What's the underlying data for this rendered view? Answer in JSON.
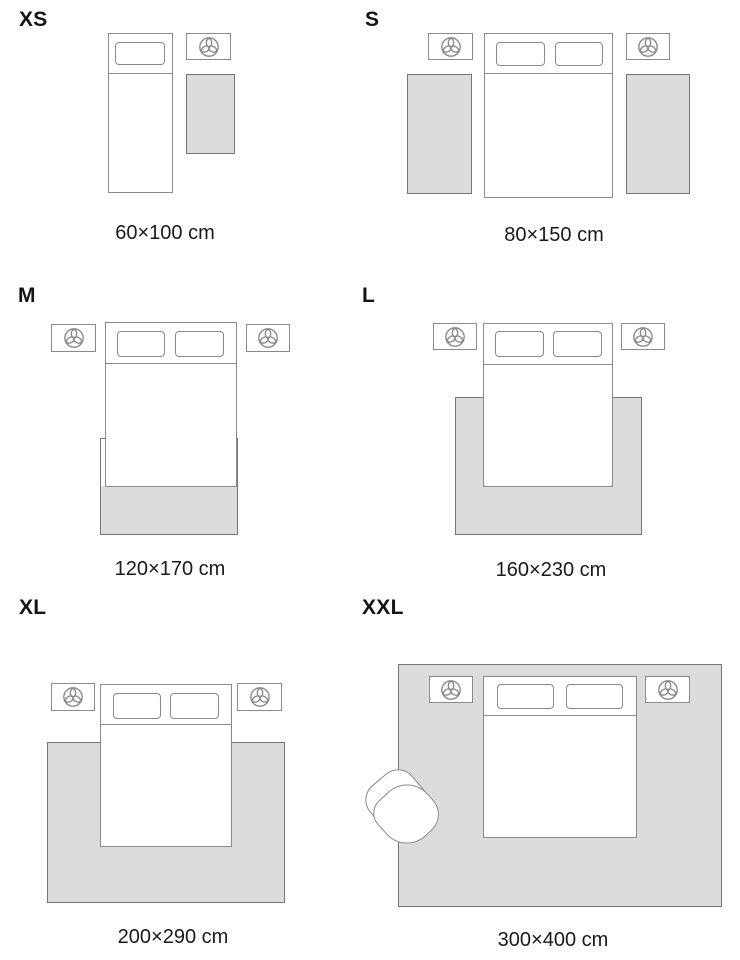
{
  "diagram": {
    "kind": "rug-size-guide",
    "unit": "cm"
  },
  "colors": {
    "background": "#ffffff",
    "furniture_outline": "#8a8a8a",
    "rug_fill": "#dcdcdc",
    "rug_border": "#767676",
    "text": "#1a1a1a"
  },
  "icons": {
    "nightstand_decor": "plant-top-view-icon"
  },
  "panels": [
    {
      "size_label": "XS",
      "dimension_label": "60×100 cm"
    },
    {
      "size_label": "S",
      "dimension_label": "80×150 cm"
    },
    {
      "size_label": "M",
      "dimension_label": "120×170 cm"
    },
    {
      "size_label": "L",
      "dimension_label": "160×230 cm"
    },
    {
      "size_label": "XL",
      "dimension_label": "200×290 cm"
    },
    {
      "size_label": "XXL",
      "dimension_label": "300×400 cm"
    }
  ]
}
